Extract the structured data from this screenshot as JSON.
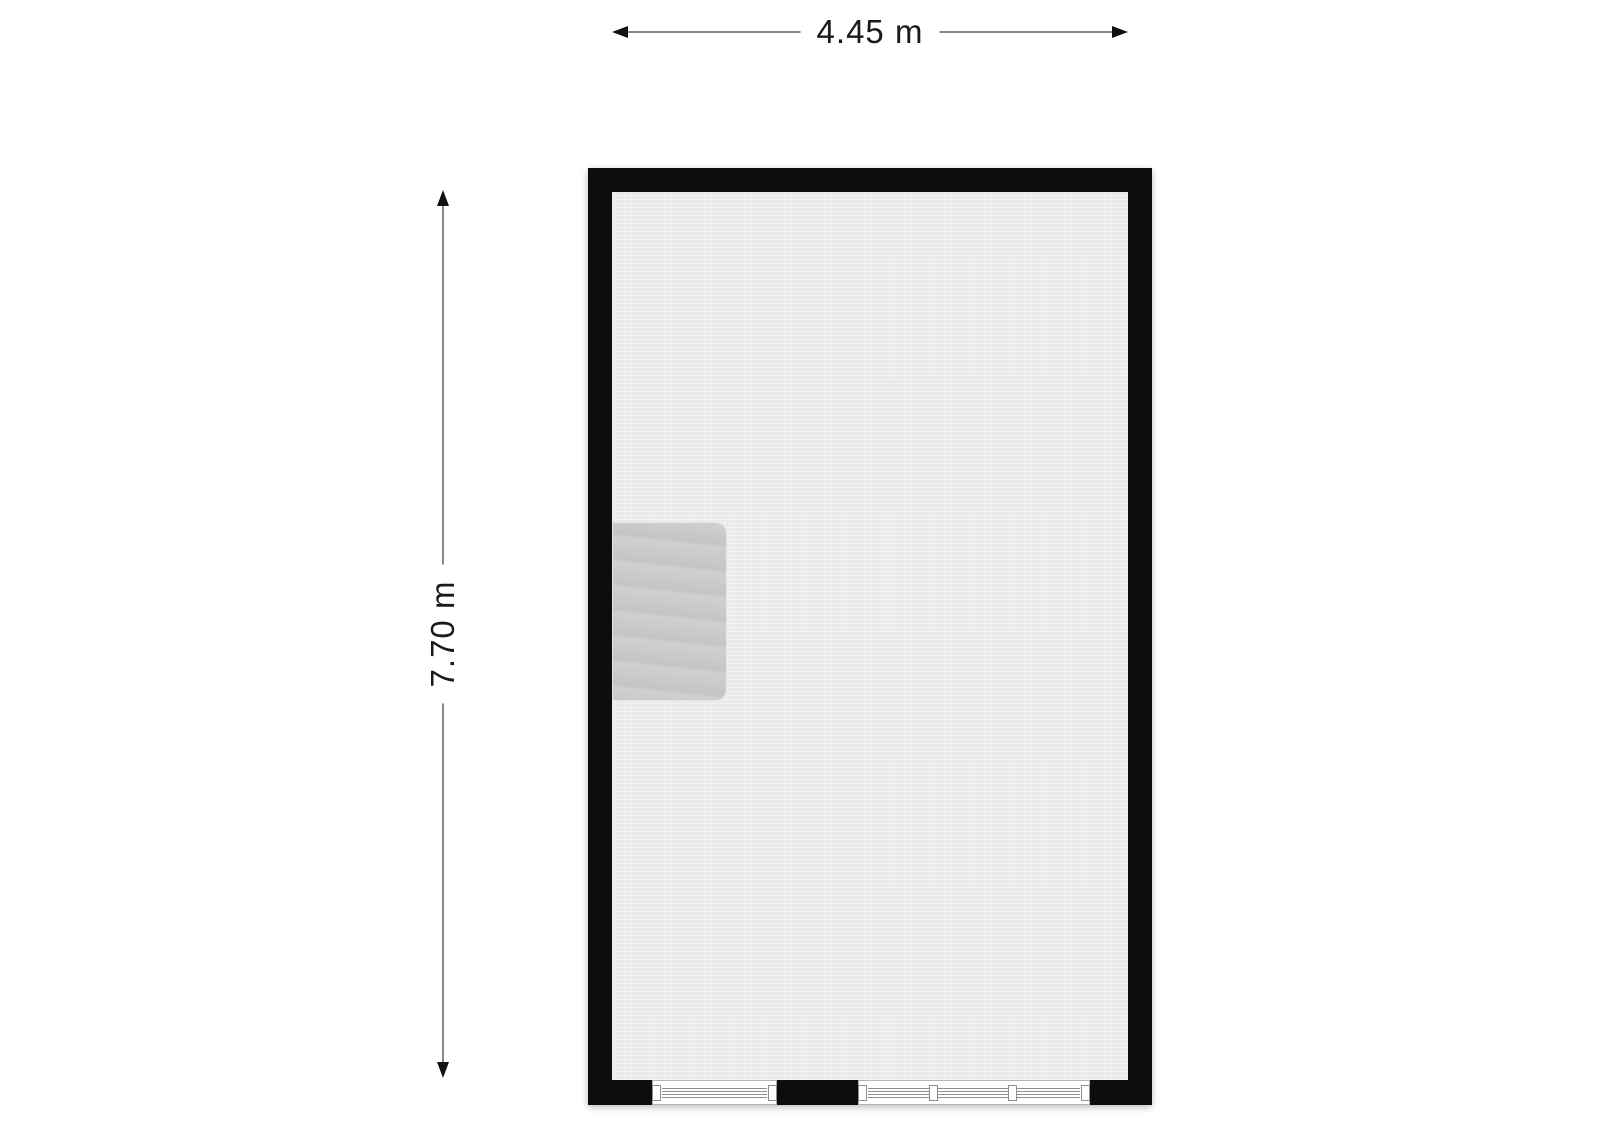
{
  "page": {
    "background": "#ffffff"
  },
  "dimensions": {
    "width_label": "4.45 m",
    "height_label": "7.70 m"
  },
  "floorplan": {
    "room": {
      "name": "room",
      "width_m": 4.45,
      "height_m": 7.7
    },
    "features": {
      "staircase": {
        "description": "staircase against left wall",
        "position": "left-middle"
      },
      "windows": [
        {
          "name": "window-single",
          "wall": "bottom",
          "panes": 1
        },
        {
          "name": "window-triple",
          "wall": "bottom",
          "panes": 3
        }
      ]
    }
  },
  "colors": {
    "wall": "#0d0d0d",
    "floor": "#ececec",
    "staircase": "#c9c9c9",
    "dimension_line": "#8a8a8a",
    "arrowhead": "#111111",
    "window_line": "#8f8f8f",
    "text": "#1a1a1a",
    "background": "#ffffff"
  }
}
